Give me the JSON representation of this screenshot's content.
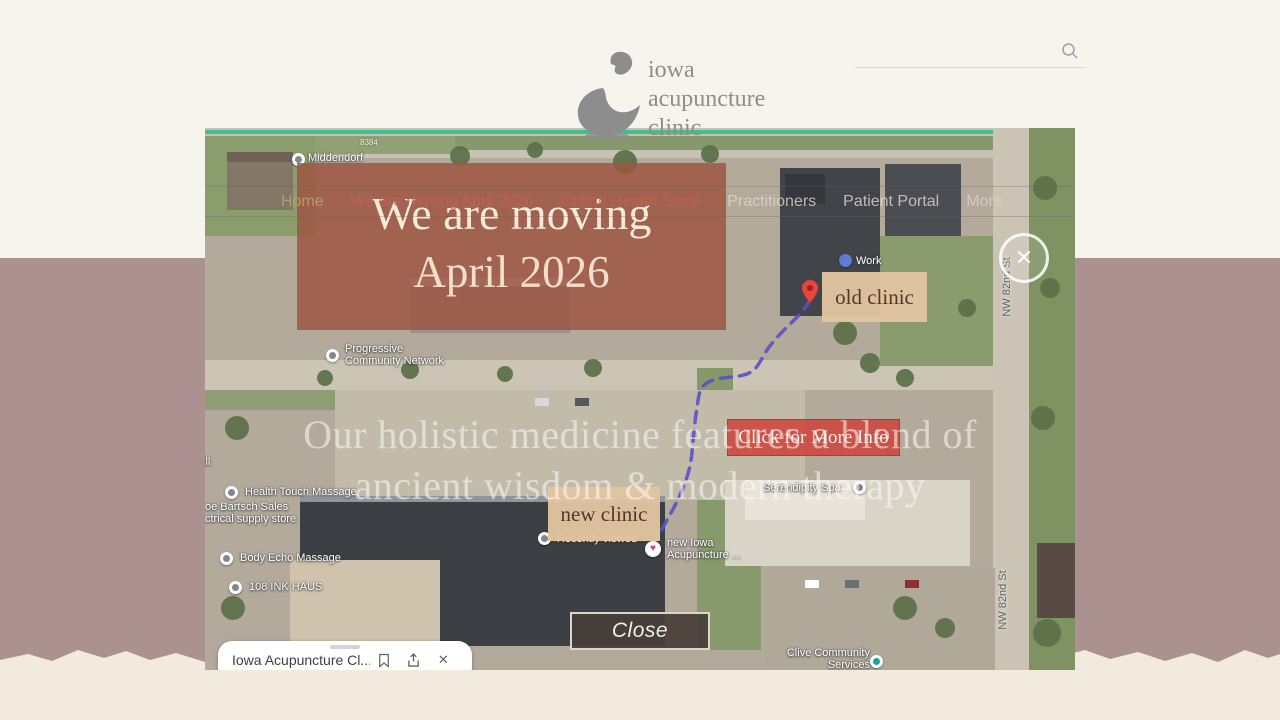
{
  "header": {
    "logo": {
      "lines": [
        "iowa",
        "acupuncture",
        "clinic"
      ]
    },
    "search": {
      "placeholder": ""
    }
  },
  "nav": {
    "items": [
      "Home",
      "We are moving April 2026",
      "Online Health Store",
      "Practitioners",
      "Patient Portal",
      "More"
    ]
  },
  "hero": {
    "line1": "Our holistic medicine features a blend of",
    "line2": "ancient wisdom & modern therapy"
  },
  "modal": {
    "banner": {
      "line1": "We are moving",
      "line2": "April 2026"
    },
    "old_clinic": "old clinic",
    "new_clinic": "new clinic",
    "more_info": "Click for More Info",
    "close": "Close",
    "close_x": "✕"
  },
  "map": {
    "labels": [
      {
        "text": "Middendorf"
      },
      {
        "text": "8384"
      },
      {
        "text": "Work"
      },
      {
        "line1": "Progressive",
        "line2": "Community Network"
      },
      {
        "text": "ill"
      },
      {
        "text": "Health Touch Massage"
      },
      {
        "line1": "oe Bartsch Sales",
        "line2": "ctrical supply store"
      },
      {
        "text": "Body Echo Massage"
      },
      {
        "text": "108 INK HAUS"
      },
      {
        "text": "Recently viewed"
      },
      {
        "line1": "new Iowa",
        "line2": "Acupuncture ..."
      },
      {
        "text": "Serendipity Spa"
      },
      {
        "line1": "Clive Community",
        "line2": "Services"
      },
      {
        "text": "NW 82nd St"
      },
      {
        "text": "NW 82nd St"
      }
    ],
    "card": {
      "title": "Iowa Acupuncture Cl...",
      "close_x": "✕"
    }
  },
  "colors": {
    "banner_bg": "#9e5642",
    "label_bg": "#e2c5a0",
    "button_red": "#ce463c",
    "close_bg": "#483e37",
    "route": "#5a51c8",
    "accent_teal": "#3fbf92",
    "band": "#ab9190",
    "cream_top": "#f7f4ee",
    "cream_bottom": "#f3eade"
  }
}
